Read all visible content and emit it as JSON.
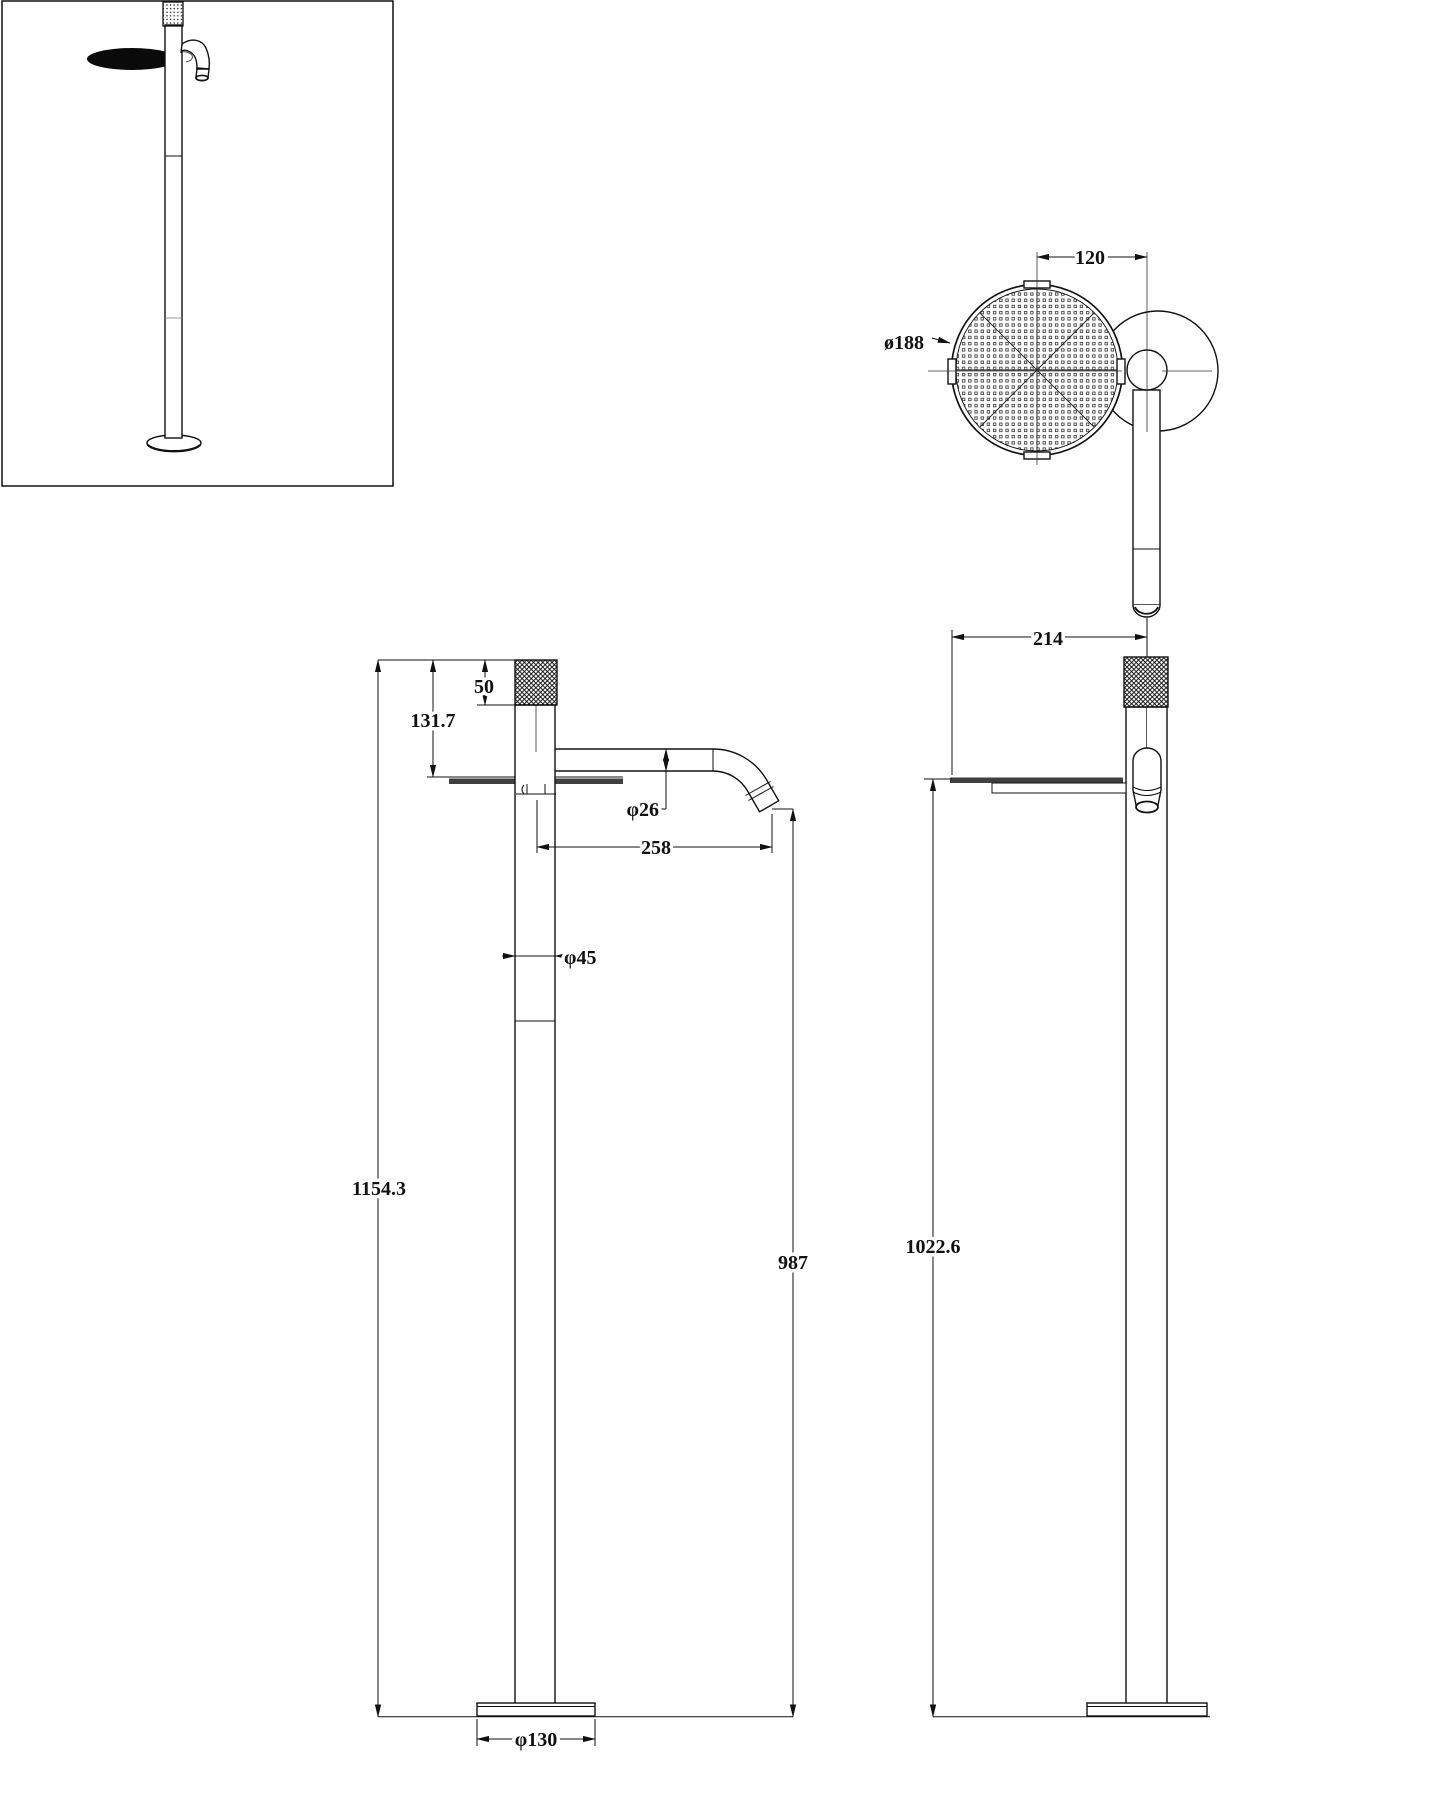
{
  "drawing": {
    "type": "technical-drawing",
    "subject": "floor-standing faucet with round dish - isometric thumbnail, top view, front view, side view",
    "dims": {
      "top_center_distance": "120",
      "dish_diameter": "ø188",
      "side_reach": "214",
      "handle_height": "50",
      "handle_to_dish": "131.7",
      "spout_tube_diameter": "φ26",
      "spout_reach": "258",
      "pole_diameter": "φ45",
      "total_height": "1154.3",
      "spout_outlet_height": "987",
      "dish_height": "1022.6",
      "base_diameter": "φ130"
    },
    "colors": {
      "line": "#111111",
      "dish_fill": "#3f3f3f",
      "background": "#ffffff"
    }
  }
}
